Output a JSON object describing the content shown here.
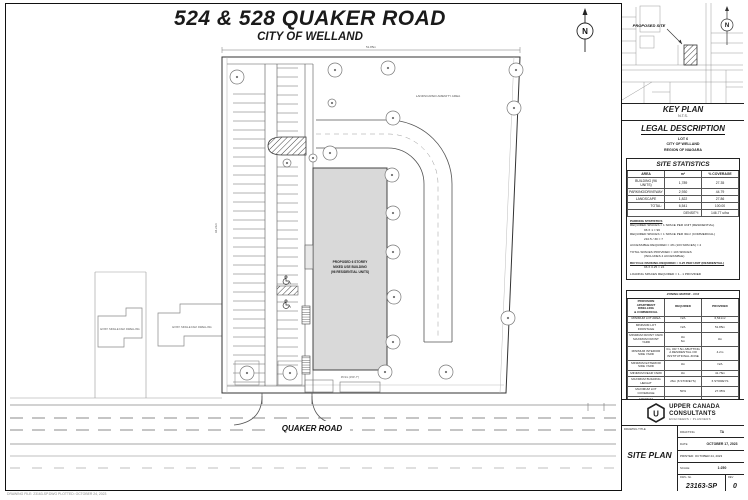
{
  "sheet": {
    "title_line1": "524 & 528 QUAKER ROAD",
    "title_line2": "CITY OF WELLAND",
    "plot_stamp": "DRAWING FILE: 23163-SP.DWG   PLOTTED: OCTOBER 24, 2023"
  },
  "site_plan": {
    "road_label": "QUAKER ROAD",
    "building_label_1": "PROPOSED 6 STOREY",
    "building_label_2": "MIXED USE BUILDING",
    "building_label_3": "(96 RESIDENTIAL UNITS)",
    "amenity_label": "LANDSCAPED AMENITY AREA",
    "neighbor_label_1": "EXIST. SINGLE FAM. DWELLING",
    "neighbor_label_2": "EXIST. SINGLE FAM. DWELLING",
    "north_letter": "N",
    "dim_top": "51.85m",
    "dim_side": "94.21m",
    "dim_building": "45.9m (150'-7\")"
  },
  "key_plan": {
    "title": "KEY PLAN",
    "scale": "N.T.S.",
    "proposed_site_label": "PROPOSED SITE",
    "north_letter": "N"
  },
  "legal": {
    "title": "LEGAL DESCRIPTION",
    "line1": "LOT 6",
    "line2": "CITY OF WELLAND",
    "line3": "REGION OF NIAGARA"
  },
  "site_stats": {
    "title": "SITE STATISTICS",
    "col_area": "AREA",
    "col_m2": "m²",
    "col_cov": "% COVERAGE",
    "rows": [
      [
        "BUILDING (96 UNITS)",
        "1,789",
        "27.35"
      ],
      [
        "PARKING/DRIVEWAY",
        "2,930",
        "44.79"
      ],
      [
        "LANDSCAPE",
        "1,822",
        "27.86"
      ]
    ],
    "total_label": "TOTAL:",
    "total_m2": "6,541",
    "total_cov": "100.00",
    "density_label": "DENSITY:",
    "density_value": "146.77 u/ha"
  },
  "parking_stats": {
    "title": "PARKING STATISTICS",
    "lines": [
      "REQUIRED SPACES = 1 SPACE PER UNIT (RESIDENTIAL)",
      "96 X 1 = 96",
      "REQUIRED SPACES = 1 SPACE PER 30m² (COMMERCIAL)",
      "210.5 / 30 = 7",
      "ACCESSIBLE REQUIRED = 4% (103 SPACES) = 4",
      "TOTAL SPACES PROVIDED = 103 SPACES",
      "(INCLUDES 4 ACCESSIBLE)",
      "BICYCLE PARKING REQUIRED = 0.25 PER UNIT (RESIDENTIAL)",
      "96 X 0.25 = 24",
      "LOADING SPACES REQUIRED = 1 - 1 PROVIDED"
    ]
  },
  "zoning": {
    "title": "ZONING MATRIX - CC2",
    "col_provision": "PROVISION\nAPARTMENT DWELLING\n& COMMERCIAL",
    "col_required": "REQUIRED",
    "col_provided": "PROVIDED",
    "rows": [
      [
        "MINIMUM LOT AREA",
        "N/A",
        "6,541m²"
      ],
      [
        "MINIMUM LOT FRONTAGE",
        "N/A",
        "51.85m"
      ],
      [
        "MINIMUM FRONT YARD\nMAXIMUM FRONT YARD",
        "3m\n6m",
        "3m"
      ],
      [
        "MINIMUM INTERIOR SIDE YARD",
        "3m, OR 7.5m ABUTTING A RESIDENTIAL OR INSTITUTIONAL ZONE",
        "4.2m"
      ],
      [
        "MINIMUM EXTERIOR SIDE YARD",
        "3m",
        "N/A"
      ],
      [
        "MINIMUM REAR YARD",
        "3m",
        "41.76m"
      ],
      [
        "MAXIMUM BUILDING HEIGHT",
        "26m (6 STOREYS)",
        "6 STOREYS"
      ],
      [
        "MAXIMUM LOT COVERAGE",
        "50%",
        "27.35%"
      ],
      [
        "MINIMUM LANDSCAPED AREA",
        "15%",
        "27.86%"
      ],
      [
        "MAXIMUM GROSS FLOOR AREA",
        "N/A",
        "10,734m²"
      ]
    ]
  },
  "firm": {
    "logo_letter": "U",
    "name_line1": "UPPER CANADA",
    "name_line2": "CONSULTANTS",
    "tagline": "ENGINEERS / PLANNERS"
  },
  "title_block": {
    "drawing_title_label": "DRAWING TITLE",
    "drawing_title": "SITE PLAN",
    "drafting_label": "DRAFTING",
    "drafting": "TA",
    "date_label": "DATE",
    "date": "OCTOBER 17, 2023",
    "printed": "PRINTED: OCTOBER 24, 2023",
    "scale_label": "SCALE",
    "scale": "1:250",
    "dwg_no_label": "DWG. No.",
    "dwg_no": "23163-SP",
    "rev_label": "REV",
    "rev": "0"
  }
}
